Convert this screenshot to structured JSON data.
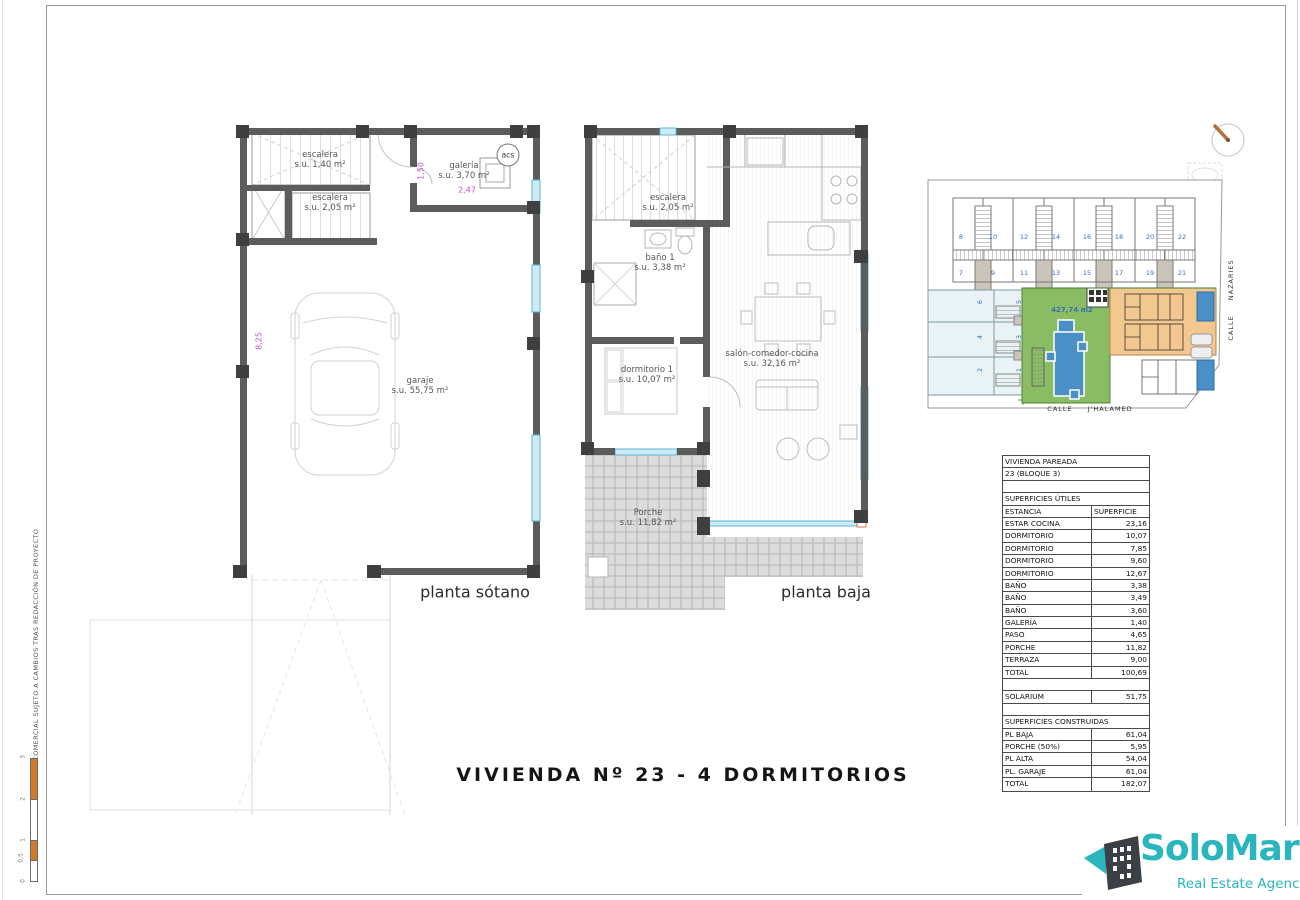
{
  "sheet": {
    "margin_note": "PLANO COMERCIAL SUJETO A CAMBIOS TRAS REDACCIÓN DE PROYECTO",
    "title": "VIVIENDA Nº 23 - 4 DORMITORIOS",
    "scale_bar": {
      "labels": [
        "3",
        "2",
        "1",
        "0,5",
        "0"
      ]
    }
  },
  "basement_plan": {
    "caption": "planta sótano",
    "stair1_name": "escalera",
    "stair1_area": "s.u. 1,40 m²",
    "stair2_name": "escalera",
    "stair2_area": "s.u. 2,05 m²",
    "galeria_name": "galería",
    "galeria_area": "s.u. 3,70 m²",
    "acs": "acs",
    "garage_name": "garaje",
    "garage_area": "s.u. 55,75 m²",
    "dim_height": "8,25",
    "dim_galeria_width": "2,47",
    "dim_galeria_height": "1,50"
  },
  "ground_plan": {
    "caption": "planta baja",
    "stair_name": "escalera",
    "stair_area": "s.u. 2,05 m²",
    "bath_name": "baño 1",
    "bath_area": "s.u. 3,38 m²",
    "bedroom_name": "dormitorio 1",
    "bedroom_area": "s.u. 10,07 m²",
    "living_name": "salón-comedor-cocina",
    "living_area": "s.u. 32,16 m²",
    "porch_name": "Porche",
    "porch_area": "s.u. 11,82 m²"
  },
  "site_plan": {
    "plots_row1": [
      "8",
      "10",
      "12",
      "14",
      "16",
      "18",
      "20",
      "22"
    ],
    "plots_row2": [
      "7",
      "9",
      "11",
      "13",
      "15",
      "17",
      "19",
      "21"
    ],
    "plots_left_col1": [
      "6",
      "4",
      "2"
    ],
    "plots_left_col2": [
      "5",
      "3",
      "1"
    ],
    "plot_area_label": "427,74 m2",
    "street_bottom": "CALLE J'HALAMED",
    "street_right": "CALLE NAZARIES"
  },
  "surface_table": {
    "rows": [
      {
        "type": "span",
        "label": "VIVIENDA PAREADA"
      },
      {
        "type": "span",
        "label": "23 (BLOQUE 3)"
      },
      {
        "type": "span",
        "label": ""
      },
      {
        "type": "span",
        "label": "SUPERFICIES ÚTILES"
      },
      {
        "type": "head",
        "label": "ESTANCIA",
        "value": "SUPERFICIE"
      },
      {
        "type": "data",
        "label": "ESTAR COCINA",
        "value": "23,16"
      },
      {
        "type": "data",
        "label": "DORMITORIO",
        "value": "10,07"
      },
      {
        "type": "data",
        "label": "DORMITORIO",
        "value": "7,85"
      },
      {
        "type": "data",
        "label": "DORMITORIO",
        "value": "9,60"
      },
      {
        "type": "data",
        "label": "DORMITORIO",
        "value": "12,67"
      },
      {
        "type": "data",
        "label": "BAÑO",
        "value": "3,38"
      },
      {
        "type": "data",
        "label": "BAÑO",
        "value": "3,49"
      },
      {
        "type": "data",
        "label": "BAÑO",
        "value": "3,60"
      },
      {
        "type": "data",
        "label": "GALERÍA",
        "value": "1,40"
      },
      {
        "type": "data",
        "label": "PASO",
        "value": "4,65"
      },
      {
        "type": "data",
        "label": "PORCHE",
        "value": "11,82"
      },
      {
        "type": "data",
        "label": "TERRAZA",
        "value": "9,00"
      },
      {
        "type": "data",
        "label": "TOTAL",
        "value": "100,69"
      },
      {
        "type": "span",
        "label": ""
      },
      {
        "type": "data",
        "label": "SOLARIUM",
        "value": "51,75"
      },
      {
        "type": "span",
        "label": ""
      },
      {
        "type": "span",
        "label": "SUPERFICIES CONSTRUIDAS"
      },
      {
        "type": "data",
        "label": "PL BAJA",
        "value": "61,04"
      },
      {
        "type": "data",
        "label": "PORCHE (50%)",
        "value": "5,95"
      },
      {
        "type": "data",
        "label": "PL ALTA",
        "value": "54,04"
      },
      {
        "type": "data",
        "label": "PL. GARAJE",
        "value": "61,04"
      },
      {
        "type": "data",
        "label": "TOTAL",
        "value": "182,07"
      }
    ]
  },
  "logo": {
    "name": "SoloMar",
    "tagline": "Real Estate Agency"
  },
  "colors": {
    "brand_teal": "#2ab5bf",
    "scale_orange": "#d4792a",
    "dim_magenta": "#c94fc9",
    "site_green": "#8abc63",
    "site_orange": "#f3c88f",
    "pool_blue": "#4a90c7",
    "plot_number_blue": "#3a6fb5",
    "wall_gray": "#5c5c5c"
  }
}
